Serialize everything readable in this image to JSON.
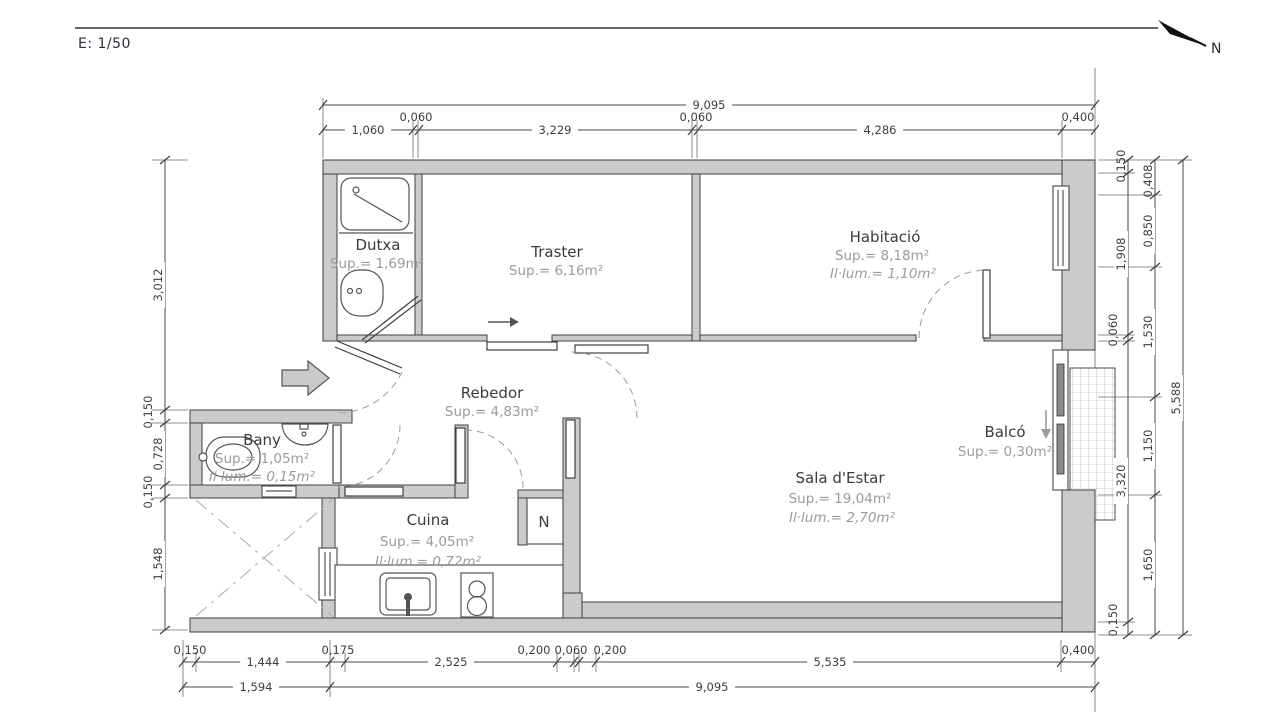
{
  "header": {
    "scale_label": "E: 1/50",
    "north_label": "N"
  },
  "rooms": {
    "dutxa": {
      "name": "Dutxa",
      "sup": "Sup.= 1,69m²"
    },
    "traster": {
      "name": "Traster",
      "sup": "Sup.= 6,16m²"
    },
    "habitacio": {
      "name": "Habitació",
      "sup": "Sup.= 8,18m²",
      "ilum": "Il·lum.= 1,10m²"
    },
    "rebedor": {
      "name": "Rebedor",
      "sup": "Sup.= 4,83m²"
    },
    "bany": {
      "name": "Bany",
      "sup": "Sup.= 1,05m²",
      "ilum": "Il·lum.= 0,15m²"
    },
    "cuina": {
      "name": "Cuina",
      "sup": "Sup.= 4,05m²",
      "ilum": "Il·lum.= 0,72m²"
    },
    "sala": {
      "name": "Sala d'Estar",
      "sup": "Sup.= 19,04m²",
      "ilum": "Il·lum.= 2,70m²"
    },
    "balco": {
      "name": "Balcó",
      "sup": "Sup.= 0,30m²"
    }
  },
  "kitchen_marker": "N",
  "dimensions": {
    "top_overall": "9,095",
    "top_row": [
      "1,060",
      "0,060",
      "3,229",
      "0,060",
      "4,286",
      "0,400"
    ],
    "left": [
      "3,012",
      "0,150",
      "0,728",
      "0,150",
      "1,548"
    ],
    "right_inner": [
      "0,150",
      "1,908",
      "0,060",
      "3,320",
      "0,150"
    ],
    "right_mid": [
      "0,408",
      "0,850",
      "1,530",
      "1,150",
      "1,650"
    ],
    "right_overall": "5,588",
    "bottom_row1": [
      "0,150",
      "1,444",
      "0,175",
      "2,525",
      "0,200",
      "0,060",
      "0,200",
      "5,535",
      "0,400"
    ],
    "bottom_row2": [
      "1,594",
      "9,095"
    ]
  },
  "colors": {
    "wall_fill": "#cbcbcb",
    "line": "#3f3f3f",
    "muted_text": "#9b9b9b"
  }
}
